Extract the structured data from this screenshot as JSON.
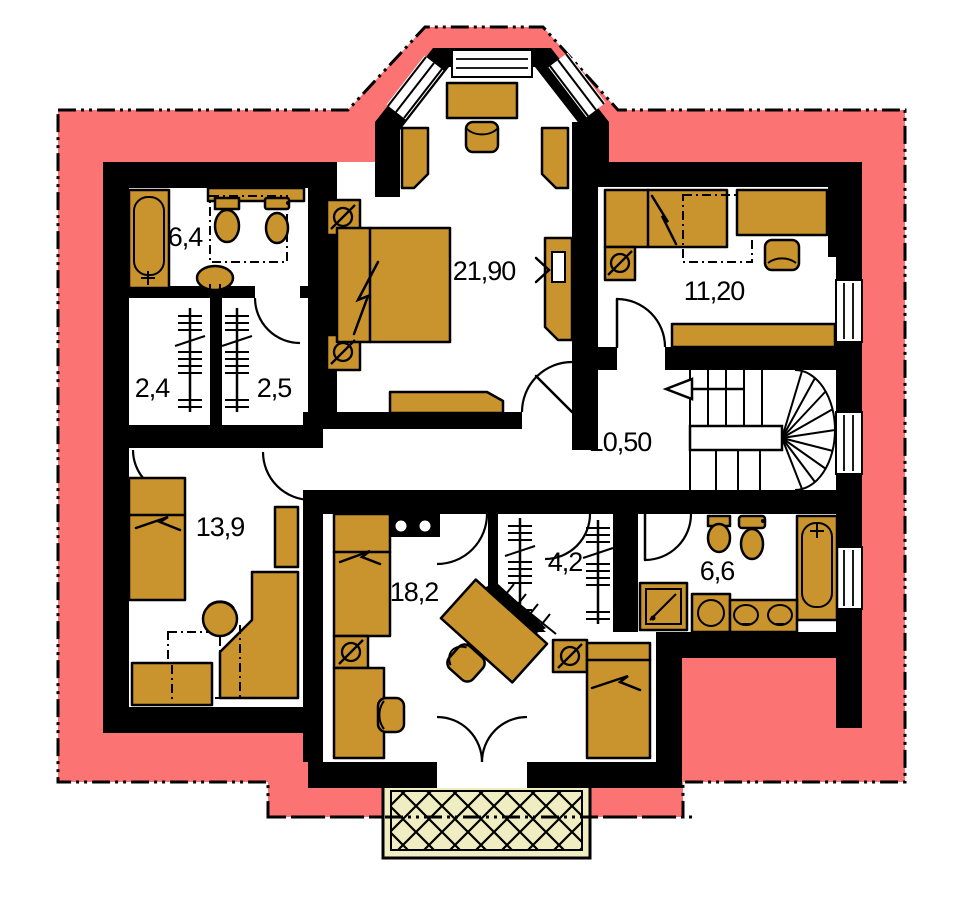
{
  "plan": {
    "title": "upper floor plan",
    "rooms": [
      {
        "name": "bathroom-upper",
        "label": "6,4"
      },
      {
        "name": "closet-a",
        "label": "2,4"
      },
      {
        "name": "closet-b",
        "label": "2,5"
      },
      {
        "name": "bedroom-large",
        "label": "21,90"
      },
      {
        "name": "bedroom-right",
        "label": "11,20"
      },
      {
        "name": "hall",
        "label": "10,50"
      },
      {
        "name": "bedroom-left",
        "label": "13,9"
      },
      {
        "name": "bedroom-center",
        "label": "18,2"
      },
      {
        "name": "closet-c",
        "label": "4,2"
      },
      {
        "name": "bathroom-lower",
        "label": "6,6"
      }
    ],
    "stairs": {
      "direction_arrow": "left"
    },
    "colors": {
      "roof": "#FB7373",
      "furniture": "#C9932E",
      "balcony": "#EFEDC1",
      "wall": "#000000"
    }
  }
}
